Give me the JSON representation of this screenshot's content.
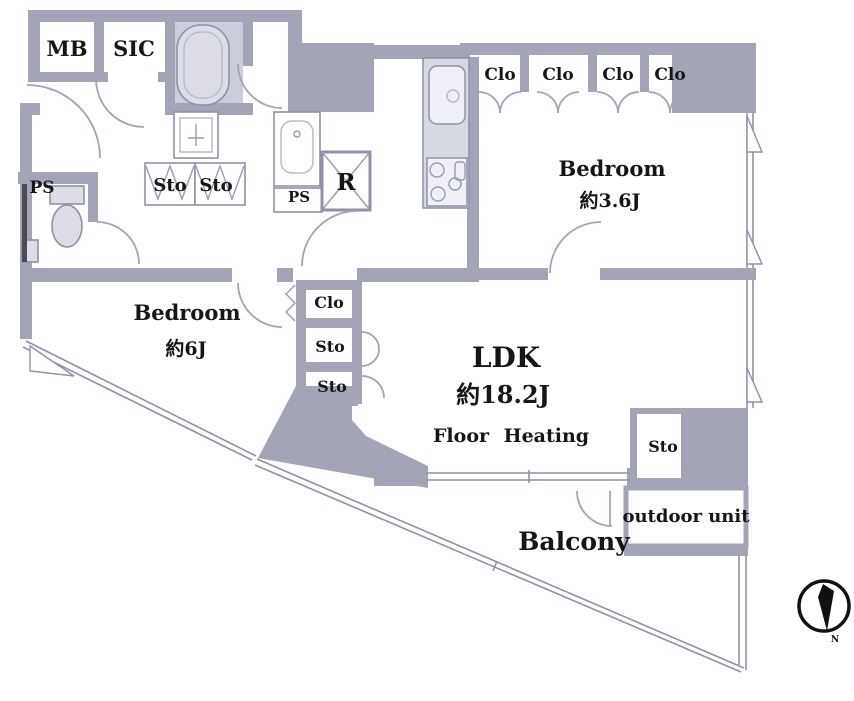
{
  "plan": {
    "labels": {
      "mb": "MB",
      "sic": "SIC",
      "ps_wc": "PS",
      "ps_mid": "PS",
      "sto_hall_1": "Sto",
      "sto_hall_2": "Sto",
      "fridge": "R",
      "clo_top_1": "Clo",
      "clo_top_2": "Clo",
      "clo_top_3": "Clo",
      "clo_top_4": "Clo",
      "clo_mid": "Clo",
      "sto_mid_1": "Sto",
      "sto_mid_2": "Sto",
      "sto_right": "Sto",
      "outdoor_unit": "outdoor unit",
      "balcony": "Balcony"
    },
    "rooms": {
      "bedroom_right": {
        "name": "Bedroom",
        "size": "約3.6J"
      },
      "bedroom_left": {
        "name": "Bedroom",
        "size": "約6J"
      },
      "ldk": {
        "name": "LDK",
        "size": "約18.2J",
        "note": "Floor Heating"
      }
    },
    "compass": {
      "label": "N"
    },
    "colors": {
      "wall": "#a3a5b7",
      "fixture": "#dcdde6",
      "counter": "#d6d8e2",
      "bath_floor": "#cbcdda",
      "line": "#8f91a5",
      "text": "#161616"
    }
  }
}
